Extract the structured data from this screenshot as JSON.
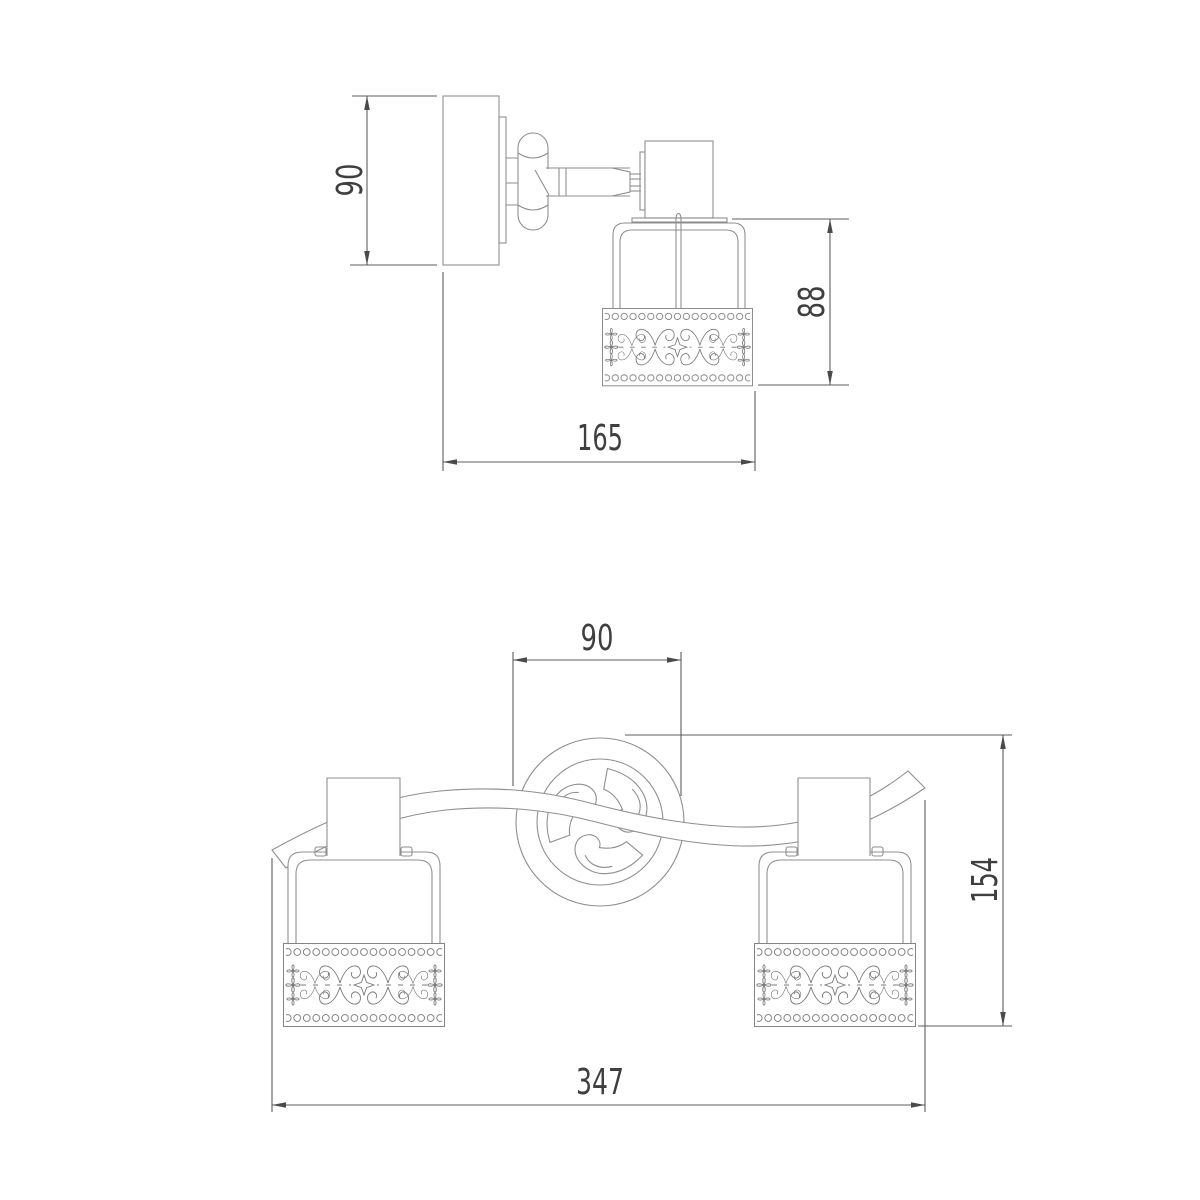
{
  "colors": {
    "background": "#ffffff",
    "drawing_line": "#8f8f8f",
    "ornament_line": "#787878",
    "dimension_line": "#5c5c5c",
    "dimension_text": "#3f3f3f"
  },
  "views": {
    "side": {
      "backplate_height": "90",
      "shade_height": "88",
      "overall_depth": "165"
    },
    "front": {
      "canopy_diameter": "90",
      "overall_height": "154",
      "overall_width": "347"
    }
  }
}
